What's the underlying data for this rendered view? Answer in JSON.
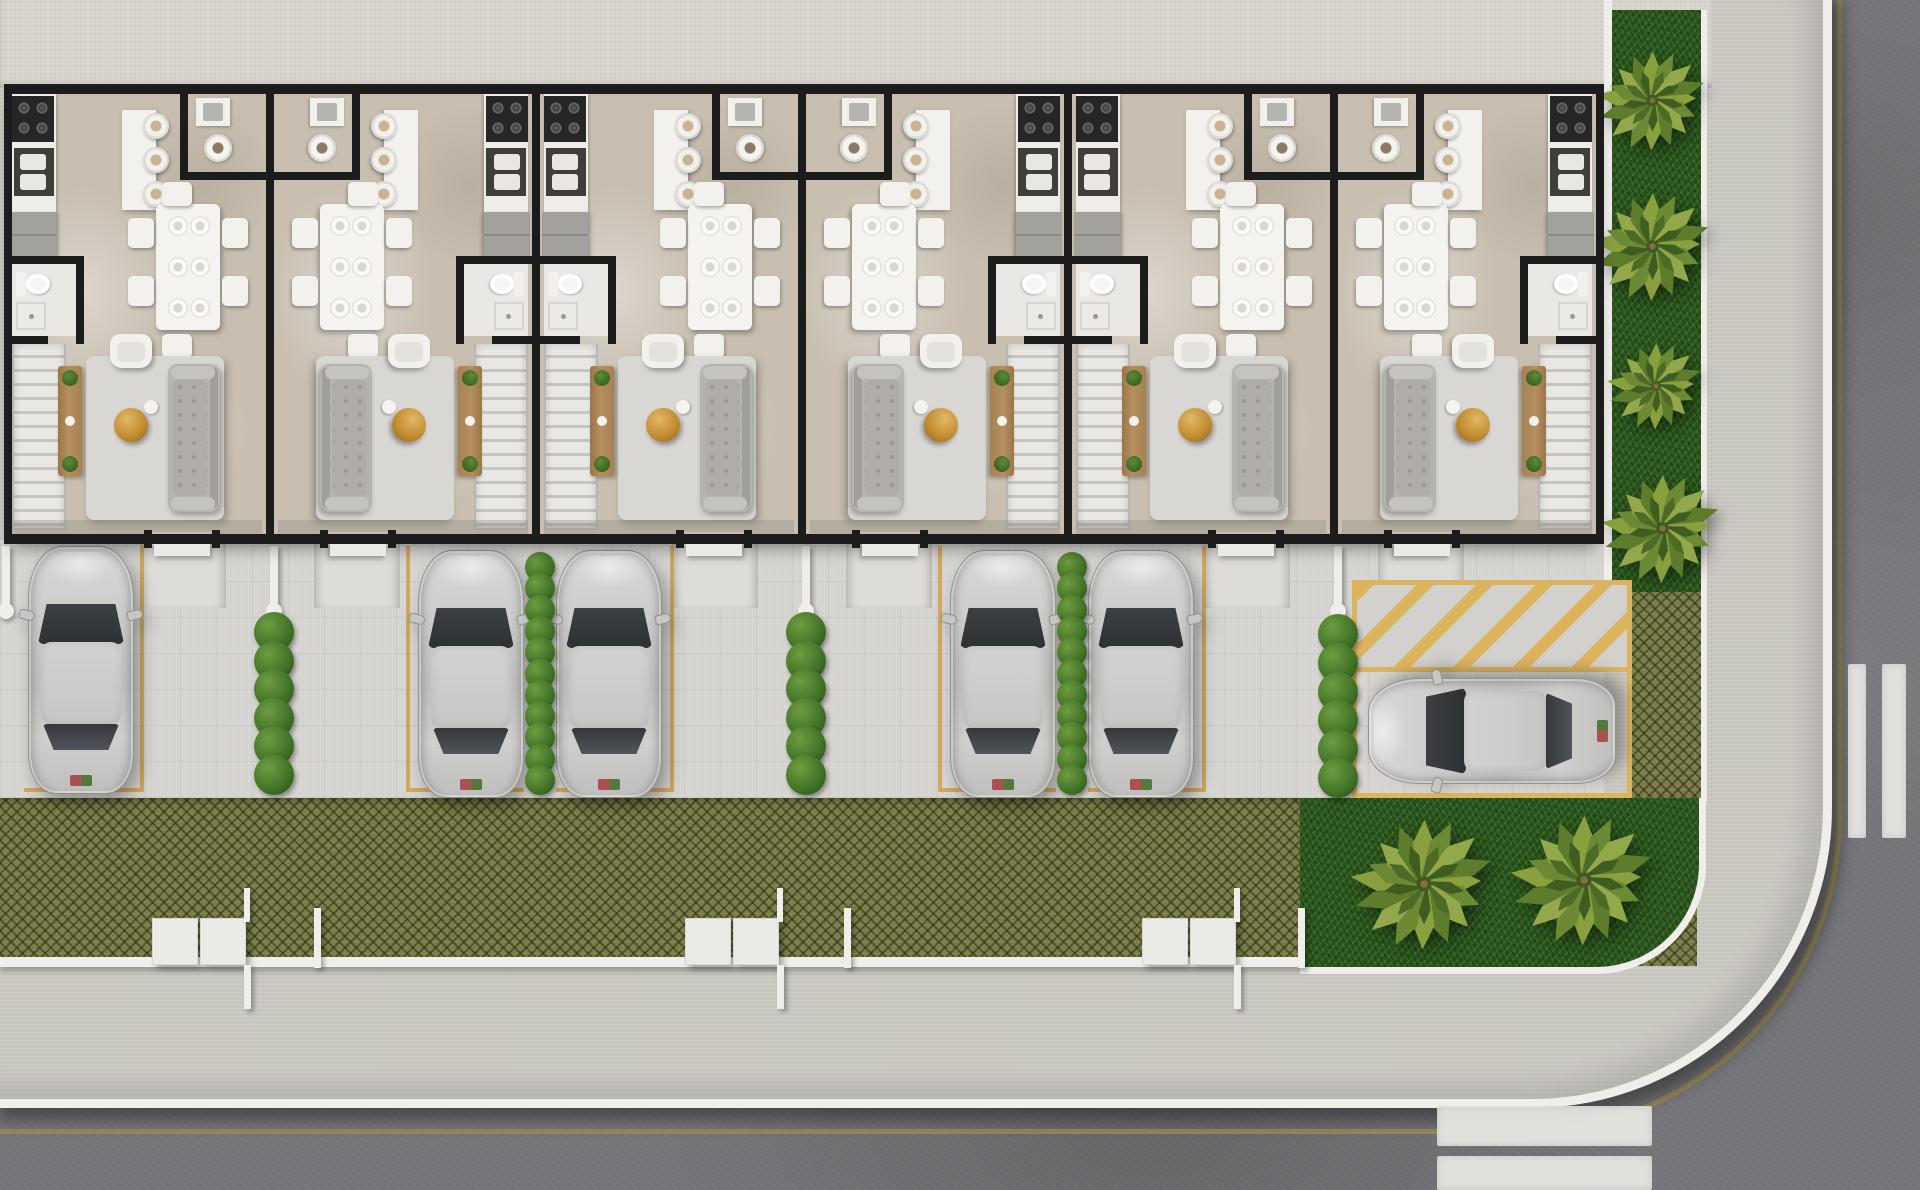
{
  "scene": {
    "type": "architectural-site-plan",
    "view": "top-down-3d-render",
    "description": "Top-down 3D render of a row of six mirrored townhouse units with furnished interiors, front driveways with five parked silver cars, hedge dividers, a reserved corner spot with a yellow hatched no-parking zone and a sixth car, a grass-paver strip, corner lawn and side garden with palm trees, a perimeter sidewalk and asphalt streets meeting at a rounded corner with white crosswalk bars",
    "width_px": 1920,
    "height_px": 1190
  },
  "palette": {
    "wall": "#1c1c1c",
    "floor": "#c8bfb1",
    "top_band": "#d6d3cc",
    "driveway": "#d6d4d0",
    "sidewalk": "#cbc8c2",
    "trim_white": "#efeeea",
    "road": "#757478",
    "gutter_yellow": "#9a8c52",
    "lane_yellow": "#cfa352",
    "hatch_yellow": "#ddb45e",
    "grass_dark": "#2c5a1f",
    "grass_paver": "#7b7d49",
    "hedge_green": "#40762a",
    "palm_green": "#8aa03f",
    "car_silver": "#cbccca",
    "car_glass": "#3c3f43",
    "furniture_white": "#f2f1ed",
    "sofa_gray": "#b6b4b1",
    "rug_gray": "#d8d7d4",
    "wood_brown": "#b08a5b",
    "gold_accent": "#c9983f"
  },
  "building": {
    "x": 4,
    "y": 84,
    "width": 1600,
    "height": 460,
    "unit_count": 6,
    "unit_width": 266,
    "units": [
      {
        "id": "unit-1",
        "mirrored": false
      },
      {
        "id": "unit-2",
        "mirrored": true
      },
      {
        "id": "unit-3",
        "mirrored": false
      },
      {
        "id": "unit-4",
        "mirrored": true
      },
      {
        "id": "unit-5",
        "mirrored": false
      },
      {
        "id": "unit-6",
        "mirrored": true
      }
    ],
    "rooms_per_unit": [
      "kitchen",
      "breakfast-bar",
      "powder-room",
      "dining-room",
      "bathroom",
      "staircase",
      "living-room",
      "entry-door"
    ]
  },
  "parking": {
    "car_count": 6,
    "car_size": {
      "w": 106,
      "h": 248
    },
    "cars": [
      {
        "id": "car-1",
        "x": 28,
        "y": 546,
        "orientation": "vertical"
      },
      {
        "id": "car-2",
        "x": 418,
        "y": 550,
        "orientation": "vertical"
      },
      {
        "id": "car-3",
        "x": 556,
        "y": 550,
        "orientation": "vertical"
      },
      {
        "id": "car-4",
        "x": 950,
        "y": 550,
        "orientation": "vertical"
      },
      {
        "id": "car-5",
        "x": 1088,
        "y": 550,
        "orientation": "vertical"
      },
      {
        "id": "car-6",
        "x": 1439,
        "y": 607,
        "orientation": "horizontal"
      }
    ],
    "hedge_rows": [
      {
        "x": 274,
        "y1": 612,
        "y2": 795,
        "r": 20
      },
      {
        "x": 540,
        "y1": 552,
        "y2": 795,
        "r": 15
      },
      {
        "x": 806,
        "y1": 612,
        "y2": 795,
        "r": 20
      },
      {
        "x": 1072,
        "y1": 552,
        "y2": 795,
        "r": 15
      },
      {
        "x": 1338,
        "y1": 614,
        "y2": 798,
        "r": 20
      }
    ],
    "divider_walls": [
      {
        "x": 6
      },
      {
        "x": 274
      },
      {
        "x": 806
      },
      {
        "x": 1338
      }
    ],
    "lane_lines_vertical": [
      142,
      408,
      672,
      940,
      1204
    ],
    "lane_lines_bottom": [
      [
        24,
        142
      ],
      [
        408,
        524
      ],
      [
        556,
        672
      ],
      [
        940,
        1056
      ],
      [
        1088,
        1204
      ]
    ],
    "no_parking_zone": {
      "x": 1352,
      "y": 580,
      "w": 280,
      "hatch_h": 92,
      "spot_h": 126
    }
  },
  "landscape": {
    "palm_trees": [
      {
        "x": 1652,
        "y": 100,
        "s": 115
      },
      {
        "x": 1652,
        "y": 246,
        "s": 125
      },
      {
        "x": 1656,
        "y": 386,
        "s": 100
      },
      {
        "x": 1662,
        "y": 528,
        "s": 125
      },
      {
        "x": 1424,
        "y": 884,
        "s": 150
      },
      {
        "x": 1584,
        "y": 880,
        "s": 150
      }
    ],
    "fence": {
      "y": 957,
      "x1": 0,
      "x2": 1302,
      "gate_clusters": [
        152,
        685,
        1142
      ],
      "posts": [
        314,
        844,
        1298
      ]
    }
  },
  "streets": {
    "crosswalk_right_bars": [
      {
        "x": 1848,
        "y": 664,
        "w": 18,
        "h": 174
      },
      {
        "x": 1882,
        "y": 664,
        "w": 24,
        "h": 174
      }
    ],
    "crosswalk_bottom_bars": [
      {
        "x": 1437,
        "y": 1106,
        "w": 215,
        "h": 40
      },
      {
        "x": 1437,
        "y": 1156,
        "w": 215,
        "h": 34
      }
    ]
  }
}
